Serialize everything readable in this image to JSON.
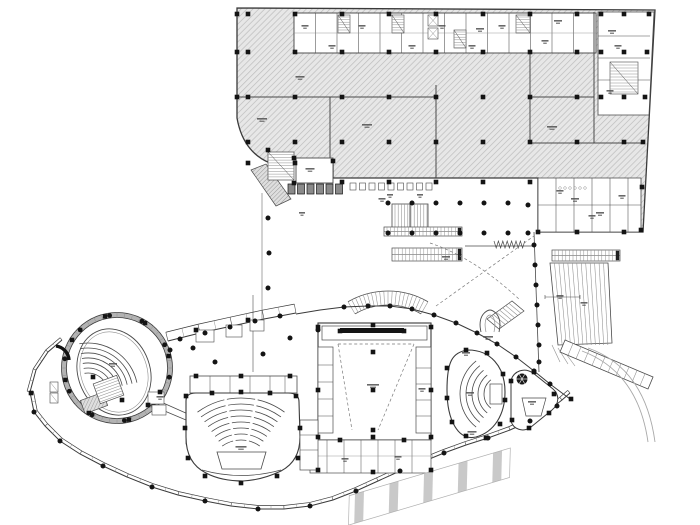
{
  "colors": {
    "outline": "#3a3a3a",
    "light": "#8f8f8f",
    "wall": "#4a4a4a",
    "dark": "#141414",
    "hatch_bg": "#e7e7e7",
    "hatch_line": "#bdbdbd",
    "hatch2_bg": "#dedede",
    "hatch2_line": "#9a9a9a",
    "stripe": "#c9c9c9",
    "dash": "#7a7a7a",
    "smudge": "#4f4f4f"
  },
  "podium": {
    "footprint": "M 237,8 L 655,10 L 643,232 L 538,232 L 538,178 L 333,178 L 333,163 L 270,163 Q 243,152 237,118 Z",
    "white_zones": [
      "M294,13 L596,13 L596,53 L294,53 Z",
      "M598,12 L654,12 L649,115 L598,115 Z",
      "M538,178 L641,178 L641,232 L538,232 Z"
    ],
    "walls": [
      [
        237,
        97,
        436,
        97
      ],
      [
        530,
        97,
        594,
        97
      ],
      [
        530,
        143,
        643,
        143
      ],
      [
        436,
        85,
        436,
        178
      ],
      [
        530,
        53,
        530,
        143
      ],
      [
        594,
        12,
        594,
        143
      ],
      [
        330,
        97,
        330,
        163
      ]
    ],
    "grid_cols": [
      248,
      295,
      342,
      389,
      436,
      483,
      530,
      577
    ],
    "grid_rows": [
      14,
      52,
      97,
      142
    ],
    "extra_squares": [
      [
        237,
        14
      ],
      [
        237,
        52
      ],
      [
        237,
        97
      ],
      [
        649,
        14
      ],
      [
        647,
        52
      ],
      [
        645,
        97
      ],
      [
        643,
        142
      ],
      [
        642,
        187
      ],
      [
        641,
        230
      ],
      [
        248,
        163
      ],
      [
        295,
        163
      ],
      [
        342,
        182
      ],
      [
        389,
        182
      ],
      [
        436,
        182
      ],
      [
        483,
        182
      ],
      [
        530,
        182
      ],
      [
        538,
        232
      ],
      [
        577,
        232
      ],
      [
        624,
        232
      ],
      [
        624,
        14
      ],
      [
        624,
        52
      ],
      [
        624,
        97
      ],
      [
        624,
        142
      ],
      [
        601,
        14
      ],
      [
        601,
        52
      ],
      [
        601,
        97
      ]
    ]
  },
  "top_band": {
    "x": 294,
    "y": 13,
    "w": 302,
    "h": 40,
    "verts": [
      315.5,
      337,
      358.5,
      380,
      401.5,
      423,
      444.5,
      466,
      487.5,
      509,
      530.5,
      552,
      573.5
    ],
    "mid_y": 33,
    "stairs": [
      [
        338,
        15,
        12,
        18
      ],
      [
        392,
        15,
        12,
        18
      ],
      [
        516,
        15,
        14,
        18
      ],
      [
        454,
        30,
        12,
        18
      ]
    ],
    "elevators": [
      [
        428,
        15,
        10,
        11
      ],
      [
        428,
        28,
        10,
        11
      ]
    ]
  },
  "right_strip": {
    "x": 598,
    "y": 12,
    "w": 52,
    "h": 103,
    "rows": [
      36,
      58,
      80
    ],
    "stair": [
      610,
      62,
      28,
      32
    ]
  },
  "br_rooms": {
    "x": 538,
    "y": 178,
    "w": 103,
    "h": 54,
    "verts": [
      556,
      574,
      592,
      610,
      628
    ],
    "mid": 205,
    "fixtures": [
      [
        560,
        188
      ],
      [
        565,
        188
      ],
      [
        570,
        188
      ],
      [
        575,
        188
      ],
      [
        580,
        188
      ],
      [
        585,
        188
      ]
    ]
  },
  "junction": {
    "room": [
      296,
      158,
      37,
      25
    ],
    "stair": [
      268,
      152,
      26,
      28
    ],
    "ramp": "M251,170 L266,164 L291,199 L276,206 Z",
    "booths_dark": {
      "x": 288,
      "y": 184,
      "n": 6,
      "w": 7,
      "h": 10,
      "gap": 2.5
    },
    "booths_light": {
      "x": 350,
      "y": 183,
      "n": 9,
      "w": 6,
      "h": 7,
      "gap": 3.5
    }
  },
  "plaza": {
    "stair": [
      392,
      204,
      36,
      25
    ],
    "escalators": [
      [
        384,
        227,
        78,
        9
      ],
      [
        392,
        248,
        70,
        13
      ],
      [
        552,
        250,
        68,
        11
      ]
    ],
    "coil": {
      "x": 494,
      "y": 241,
      "n": 14,
      "dx": 2.2,
      "h": 7
    },
    "rail": [
      465,
      246,
      535,
      246
    ],
    "west_line": [
      262,
      193,
      262,
      319
    ],
    "section_line": [
      253,
      295,
      253,
      372
    ],
    "colonnade": [
      534,
      232,
      539,
      372
    ],
    "dashed": [
      "M436,306 L534,236",
      "M430,243 Q475,258 520,300"
    ]
  },
  "amphi": {
    "cx": 388,
    "cy": 371,
    "r_in": 66,
    "r_out": 80,
    "a0": 240,
    "a1": 300,
    "ticks": 20
  },
  "diag_stair": {
    "e1": [
      487,
      319,
      512,
      301
    ],
    "e2": [
      499,
      329,
      524,
      311
    ],
    "lines": 8
  },
  "horseshoe": {
    "d1": "M481,332 C477,315 487,310 490,310 C493,310 503,315 499,332",
    "d2": "M486,332 C483,319 488,315 490,315 C492,315 497,319 494,332"
  },
  "facades": {
    "bottom": {
      "pts": [
        [
          30,
          392
        ],
        [
          34,
          412
        ],
        [
          45,
          426
        ],
        [
          60,
          441
        ],
        [
          80,
          454
        ],
        [
          103,
          466
        ],
        [
          127,
          477
        ],
        [
          152,
          487
        ],
        [
          178,
          495
        ],
        [
          205,
          501
        ],
        [
          231,
          506
        ],
        [
          258,
          509
        ],
        [
          284,
          509
        ],
        [
          310,
          506
        ],
        [
          333,
          500
        ],
        [
          356,
          491
        ],
        [
          378,
          481
        ],
        [
          400,
          471
        ],
        [
          422,
          462
        ],
        [
          444,
          453
        ],
        [
          466,
          445
        ],
        [
          488,
          438
        ],
        [
          510,
          430
        ],
        [
          530,
          421
        ],
        [
          548,
          411
        ],
        [
          562,
          400
        ],
        [
          570,
          393
        ]
      ],
      "w": 3.5
    },
    "tip_left": {
      "pts": [
        [
          30,
          392
        ],
        [
          36,
          370
        ],
        [
          48,
          352
        ],
        [
          62,
          340
        ]
      ],
      "w": 3
    },
    "top_right": {
      "pts": [
        [
          296,
          314
        ],
        [
          320,
          310
        ],
        [
          344,
          307
        ],
        [
          368,
          306
        ],
        [
          390,
          306
        ],
        [
          412,
          309
        ],
        [
          434,
          315
        ],
        [
          456,
          323
        ],
        [
          477,
          333
        ],
        [
          497,
          344
        ],
        [
          516,
          357
        ],
        [
          534,
          371
        ],
        [
          550,
          384
        ],
        [
          562,
          393
        ],
        [
          570,
          399
        ]
      ],
      "w": 0
    },
    "gallery": {
      "pts": [
        [
          168,
          341
        ],
        [
          200,
          333
        ],
        [
          232,
          326
        ],
        [
          264,
          319
        ],
        [
          296,
          313
        ]
      ],
      "w": 9
    }
  },
  "round_theater": {
    "cx": 117,
    "cy": 368,
    "r_outer": 55.5,
    "r_mid": 53,
    "r_inner": 50.5,
    "ring_ticks": 44,
    "ring_dots": 10,
    "ring_squares": 8,
    "ellipse": {
      "cx": 114,
      "cy": 372,
      "rx": 36,
      "ry": 44,
      "rot": -20
    },
    "seats": {
      "cx": 88,
      "cy": 393,
      "r0": 20,
      "dr": 5,
      "rows": 7,
      "a0": -100,
      "a1": -12
    },
    "stage": [
      82,
      396,
      24,
      14,
      -20
    ],
    "gallery_rooms": [
      [
        196,
        330,
        18,
        12
      ],
      [
        226,
        325,
        16,
        12
      ],
      [
        250,
        320,
        14,
        11
      ]
    ]
  },
  "main_aud": {
    "outline": "M186,401 Q186,393 196,393 L288,393 Q299,393 299,402 L300,437 Q300,461 281,471 Q262,480 243,481 Q221,481 206,473 Q186,463 186,437 Z",
    "seats": {
      "cx": 241,
      "cy": 472,
      "r0": 32,
      "dr": 6,
      "rows": 8,
      "a0": 234,
      "a1": 306
    },
    "aisles": [
      258,
      282
    ],
    "stage": "M217,452 L266,452 L261,469 L222,469 Z",
    "pit": "M202,470 Q241,481 281,470",
    "top_band": [
      190,
      376,
      107,
      17
    ],
    "band_verts": [
      210,
      230,
      250,
      270,
      285
    ],
    "left_rooms": [
      186,
      398,
      10,
      46
    ]
  },
  "stage_house": {
    "outer": [
      318,
      323,
      113,
      117
    ],
    "top_band": [
      322,
      326,
      105,
      14
    ],
    "black_bar": [
      340,
      328,
      64,
      5
    ],
    "inner_dash": [
      "M338,344 L352,430",
      "M414,344 L378,430",
      "M338,344 L414,344"
    ],
    "left_rooms": {
      "x": 318,
      "y": 347,
      "w": 15,
      "h": 86,
      "hs": [
        365,
        382,
        399,
        416
      ]
    },
    "right_rooms": {
      "x": 416,
      "y": 347,
      "w": 15,
      "h": 86,
      "hs": [
        368,
        384,
        400,
        416
      ]
    },
    "bottom_rooms": {
      "x": 310,
      "y": 440,
      "w": 121,
      "h": 33,
      "vs": [
        327,
        344,
        361,
        378,
        395,
        412
      ],
      "mid": 456
    },
    "aud_link_rooms": {
      "x": 300,
      "y": 420,
      "w": 18,
      "h": 50,
      "hs": [
        435,
        450
      ]
    }
  },
  "side_theater": {
    "outline": "M447,390 C447,362 452,352 468,350 C490,350 505,366 505,392 C505,415 494,432 476,437 C458,441 447,420 447,390 Z",
    "seats": {
      "cx": 502,
      "cy": 394,
      "r0": 18,
      "dr": 6,
      "rows": 5,
      "a0": 128,
      "a1": 232
    },
    "stage": [
      490,
      384,
      12,
      20
    ]
  },
  "triangle": {
    "outline": "M511,380 C514,371 524,367 533,373 L553,389 C560,395 559,404 552,410 L531,427 C523,433 513,429 511,421 Z",
    "spiral": [
      522,
      379,
      5.5
    ],
    "room": "M522,398 L546,398 L541,416 L526,416 Z"
  },
  "right_stair": {
    "rect": [
      550,
      263,
      58,
      82
    ],
    "step": 4.2,
    "fan": [
      "M552,345 L560,362",
      "M558,348 L568,364",
      "M564,351 L575,366"
    ],
    "band": {
      "x1": 560,
      "y1": 352,
      "x2": 648,
      "y2": 389,
      "w": 13,
      "ticks": 11
    },
    "arcs": [
      "M588,348 Q645,368 655,442",
      "M582,351 Q638,372 648,442"
    ],
    "dim": [
      545,
      297,
      580,
      297
    ]
  },
  "zebra": {
    "x": 355,
    "y": 494,
    "len": 162,
    "w": 28,
    "angle": -16.5,
    "stripes": 9
  },
  "left_tip": {
    "stair": [
      96,
      379,
      25,
      21,
      -20
    ],
    "elev": [
      [
        50,
        382
      ],
      [
        50,
        393
      ]
    ],
    "arc": "M56,346 A 15 15 0 0 1 69,360",
    "rooms": [
      [
        148,
        392,
        16,
        12
      ],
      [
        152,
        405,
        14,
        10
      ]
    ]
  },
  "links": [
    [
      148,
      404,
      186,
      420
    ],
    [
      152,
      398,
      188,
      414
    ]
  ],
  "dots": [
    [
      34,
      412
    ],
    [
      60,
      441
    ],
    [
      103,
      466
    ],
    [
      152,
      487
    ],
    [
      205,
      501
    ],
    [
      258,
      509
    ],
    [
      310,
      506
    ],
    [
      356,
      491
    ],
    [
      400,
      471
    ],
    [
      444,
      453
    ],
    [
      488,
      438
    ],
    [
      530,
      421
    ],
    [
      557,
      406
    ],
    [
      344,
      307
    ],
    [
      368,
      306
    ],
    [
      390,
      306
    ],
    [
      412,
      309
    ],
    [
      434,
      315
    ],
    [
      456,
      323
    ],
    [
      477,
      333
    ],
    [
      497,
      344
    ],
    [
      516,
      357
    ],
    [
      534,
      371
    ],
    [
      550,
      384
    ],
    [
      180,
      339
    ],
    [
      205,
      333
    ],
    [
      230,
      327
    ],
    [
      255,
      321
    ],
    [
      280,
      316
    ],
    [
      388,
      203
    ],
    [
      412,
      203
    ],
    [
      436,
      203
    ],
    [
      460,
      203
    ],
    [
      484,
      203
    ],
    [
      508,
      203
    ],
    [
      528,
      205
    ],
    [
      388,
      233
    ],
    [
      412,
      233
    ],
    [
      436,
      233
    ],
    [
      460,
      233
    ],
    [
      484,
      233
    ],
    [
      508,
      233
    ],
    [
      528,
      233
    ],
    [
      534,
      245
    ],
    [
      535,
      265
    ],
    [
      536,
      285
    ],
    [
      537,
      305
    ],
    [
      538,
      325
    ],
    [
      539,
      345
    ],
    [
      539,
      362
    ],
    [
      268,
      218
    ],
    [
      269,
      253
    ],
    [
      268,
      288
    ],
    [
      170,
      350
    ],
    [
      193,
      348
    ],
    [
      215,
      362
    ],
    [
      263,
      354
    ],
    [
      290,
      338
    ],
    [
      318,
      330
    ]
  ],
  "squares": [
    [
      186,
      396
    ],
    [
      212,
      393
    ],
    [
      241,
      392
    ],
    [
      270,
      393
    ],
    [
      296,
      396
    ],
    [
      185,
      428
    ],
    [
      300,
      428
    ],
    [
      188,
      458
    ],
    [
      298,
      458
    ],
    [
      205,
      476
    ],
    [
      241,
      483
    ],
    [
      277,
      476
    ],
    [
      196,
      376
    ],
    [
      241,
      376
    ],
    [
      290,
      376
    ],
    [
      318,
      327
    ],
    [
      373,
      325
    ],
    [
      431,
      327
    ],
    [
      318,
      390
    ],
    [
      373,
      390
    ],
    [
      431,
      390
    ],
    [
      318,
      437
    ],
    [
      373,
      437
    ],
    [
      431,
      437
    ],
    [
      340,
      331
    ],
    [
      404,
      331
    ],
    [
      373,
      352
    ],
    [
      373,
      430
    ],
    [
      340,
      440
    ],
    [
      404,
      440
    ],
    [
      318,
      470
    ],
    [
      373,
      472
    ],
    [
      431,
      470
    ],
    [
      447,
      368
    ],
    [
      447,
      398
    ],
    [
      452,
      422
    ],
    [
      466,
      436
    ],
    [
      486,
      438
    ],
    [
      500,
      424
    ],
    [
      505,
      400
    ],
    [
      503,
      374
    ],
    [
      487,
      353
    ],
    [
      466,
      350
    ],
    [
      511,
      381
    ],
    [
      534,
      372
    ],
    [
      554,
      394
    ],
    [
      549,
      413
    ],
    [
      529,
      428
    ],
    [
      512,
      420
    ],
    [
      93,
      377
    ],
    [
      122,
      400
    ],
    [
      148,
      405
    ],
    [
      160,
      392
    ],
    [
      268,
      150
    ],
    [
      294,
      158
    ],
    [
      333,
      161
    ],
    [
      294,
      183
    ],
    [
      196,
      330
    ],
    [
      248,
      320
    ],
    [
      31,
      393
    ],
    [
      571,
      399
    ]
  ],
  "smudges": [
    [
      262,
      118,
      10
    ],
    [
      300,
      76,
      9
    ],
    [
      367,
      124,
      10
    ],
    [
      552,
      126,
      10
    ],
    [
      480,
      28,
      8
    ],
    [
      558,
      20,
      8
    ],
    [
      612,
      30,
      8
    ],
    [
      575,
      198,
      8
    ],
    [
      600,
      212,
      8
    ],
    [
      310,
      168,
      9
    ],
    [
      382,
      198,
      7
    ],
    [
      446,
      256,
      8
    ],
    [
      488,
      336,
      10
    ],
    [
      241,
      446,
      11
    ],
    [
      373,
      384,
      12
    ],
    [
      470,
      392,
      8
    ],
    [
      113,
      363,
      8
    ],
    [
      160,
      396,
      7
    ],
    [
      532,
      401,
      8
    ],
    [
      466,
      352,
      8
    ],
    [
      472,
      431,
      9
    ],
    [
      345,
      458,
      7
    ],
    [
      398,
      456,
      7
    ],
    [
      422,
      388,
      7
    ],
    [
      560,
      295,
      7
    ],
    [
      584,
      302,
      7
    ],
    [
      305,
      25,
      7
    ],
    [
      332,
      45,
      7
    ],
    [
      362,
      25,
      7
    ],
    [
      412,
      45,
      7
    ],
    [
      442,
      25,
      7
    ],
    [
      472,
      45,
      7
    ],
    [
      502,
      25,
      7
    ],
    [
      545,
      40,
      7
    ],
    [
      618,
      45,
      7
    ],
    [
      610,
      90,
      7
    ],
    [
      560,
      190,
      7
    ],
    [
      592,
      215,
      7
    ],
    [
      622,
      195,
      7
    ],
    [
      302,
      212,
      6
    ],
    [
      390,
      194,
      6
    ],
    [
      420,
      194,
      6
    ]
  ]
}
